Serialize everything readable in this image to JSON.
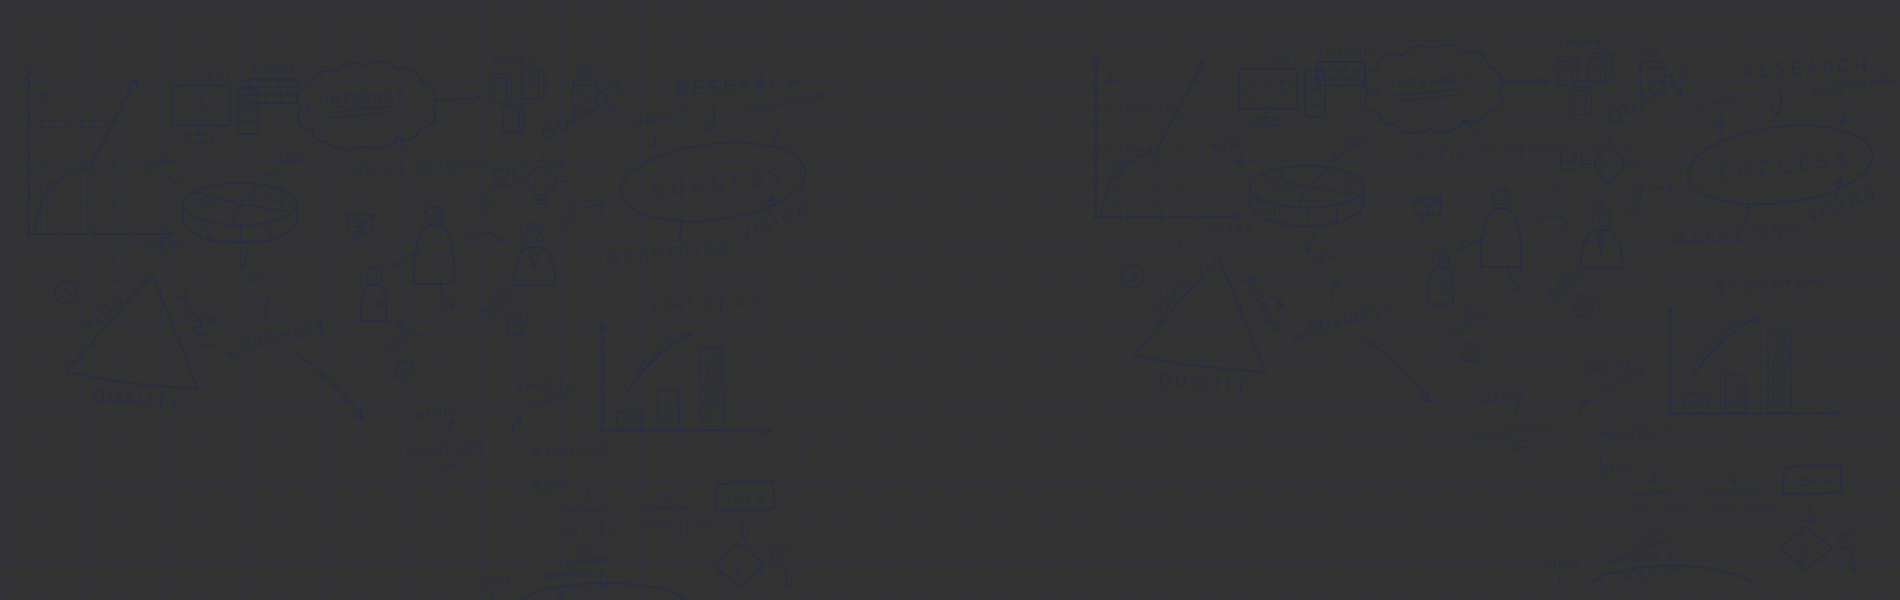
{
  "meta": {
    "width": 1900,
    "height": 600,
    "description": "business doodles hero banner on blue graph paper"
  },
  "background": {
    "top_color": "#46548b",
    "mid_color": "#7083c1",
    "glow_color": "#8ea5e4",
    "grid_minor_color": "rgba(26,40,86,0.09)",
    "grid_major_color": "rgba(26,40,86,0.17)",
    "doodle_ink_color": "#1f2a52"
  },
  "doodles": {
    "client": "CLIENT",
    "firewall": "FIREWALL",
    "internet": "INTERNET",
    "server": "SERVER",
    "db": "DB",
    "quality": "QUALITY",
    "strategy": "STRATEGY",
    "research": "RESEARCH",
    "innovation": "INNOVATION",
    "success": "SUCCESS",
    "vision": "VISION",
    "marketing": "MARKETING",
    "social_network": "SOCIAL NETWORK",
    "idea_side": "IDEA",
    "go": "GO",
    "sms": "SMS",
    "pct_35": "35%",
    "pct_50": "50%",
    "pct_15": "15%",
    "years": "YEARS",
    "dollar": "$",
    "time": "TIME",
    "money": "MONEY",
    "quality_triangle": "QUALITY",
    "business": "BUSINESS",
    "email": "EMAIL",
    "blog": "BLOG",
    "forum": "FORUM",
    "statistics": "STATISTICS",
    "growth": "GROWTH",
    "engine": "ENGINE",
    "support": "SUPPORT",
    "portfolio": "PORTFOLIO",
    "media": "MEDIA",
    "advertising": "ADVERTISING",
    "news": "NEWS",
    "last_year_amount": "500.000",
    "last_year": "LAST YEAR",
    "this_year_amount": "1.000.000",
    "this_year": "THIS YEAR",
    "idea_box": "IDEA",
    "yes": "YES",
    "our": "OUR",
    "company": "COMPANY",
    "competitor": "COMPETITOR",
    "other": "OTHER"
  }
}
